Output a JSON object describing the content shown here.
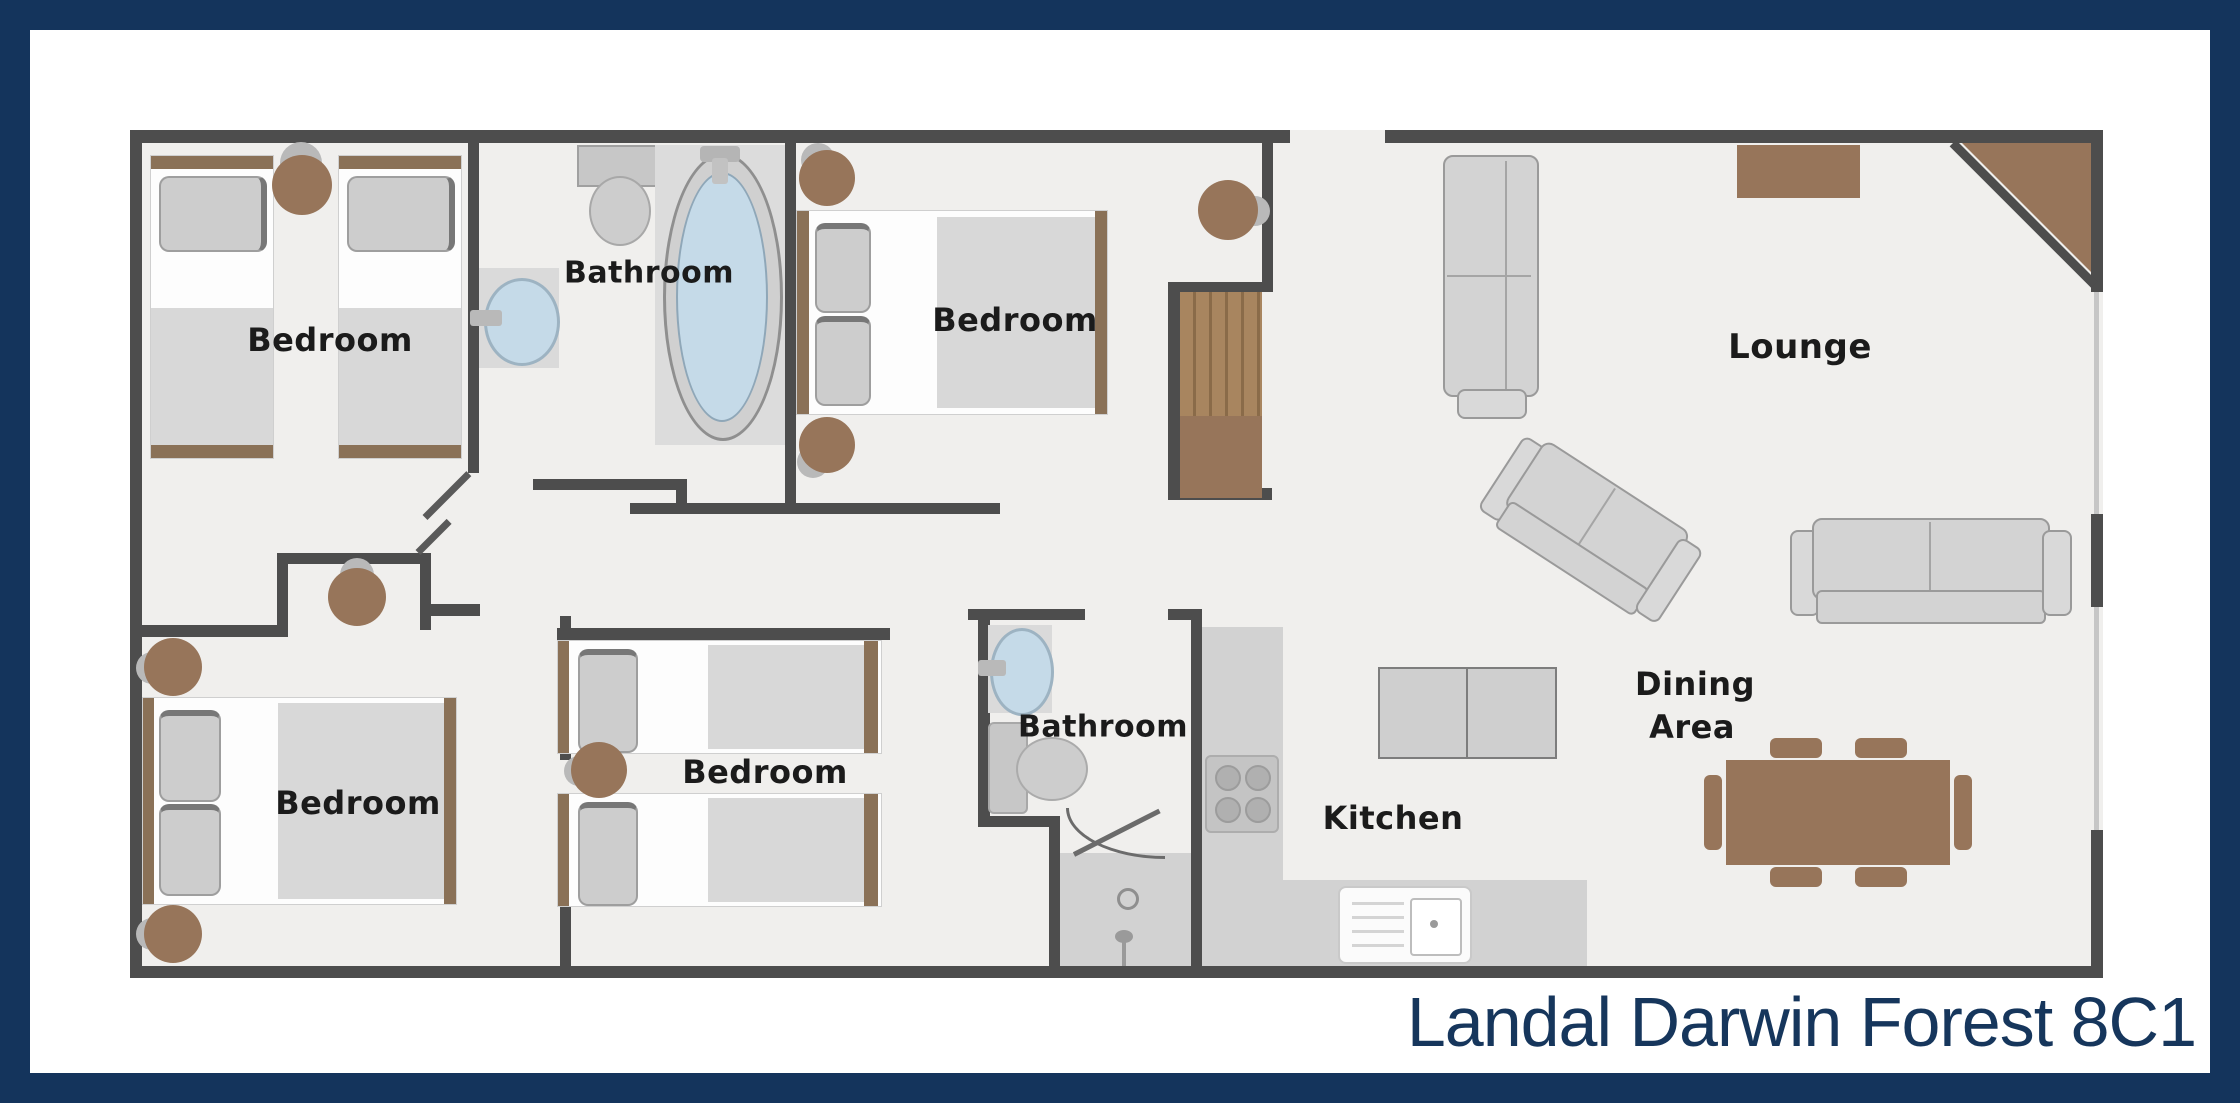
{
  "title": {
    "text": "Landal Darwin Forest 8C1"
  },
  "rooms": {
    "bedroom_top_left": {
      "label": "Bedroom"
    },
    "bathroom_top": {
      "label": "Bathroom"
    },
    "bedroom_top_middle": {
      "label": "Bedroom"
    },
    "lounge": {
      "label": "Lounge"
    },
    "bedroom_bottom_left": {
      "label": "Bedroom"
    },
    "bedroom_bottom_middle": {
      "label": "Bedroom"
    },
    "bathroom_bottom": {
      "label": "Bathroom"
    },
    "kitchen": {
      "label": "Kitchen"
    },
    "dining": {
      "line1": "Dining",
      "line2": "Area"
    }
  },
  "palette": {
    "frame": "#14345c",
    "wall": "#4d4d4d",
    "floor": "#f0efed",
    "furn": "#d3d3d3",
    "furnb": "#9a9a9a",
    "wood": "#97755a",
    "wooddark": "#8a6b49",
    "wooddeep": "#8a7157",
    "water": "#c5dae8",
    "label": "#1b1b1b",
    "title": "#16365c",
    "window": "#c6c6c6",
    "blanket": "#d8d8d8",
    "pillow": "#cdcdcd"
  }
}
